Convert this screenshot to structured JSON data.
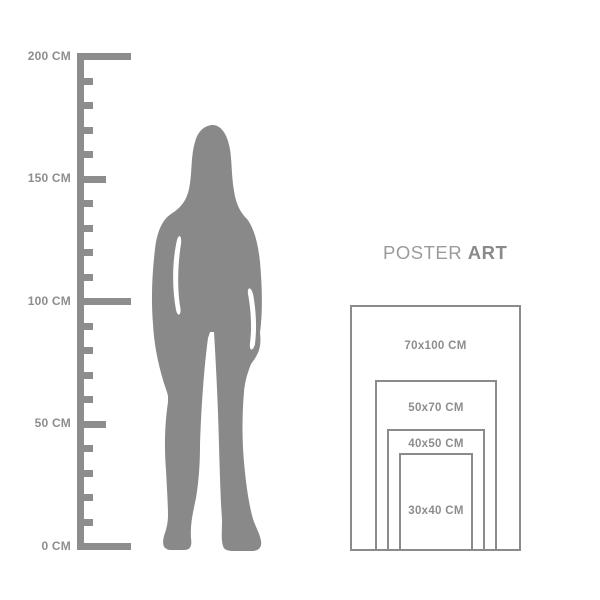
{
  "title": {
    "normal": "POSTER",
    "bold": "ART"
  },
  "ruler": {
    "unit": "CM",
    "labels": [
      "200 CM",
      "150 CM",
      "100 CM",
      "50 CM",
      "0 CM"
    ]
  },
  "posters": {
    "sizes": [
      {
        "label": "70x100 CM"
      },
      {
        "label": "50x70 CM"
      },
      {
        "label": "40x50 CM"
      },
      {
        "label": "30x40 CM"
      }
    ]
  },
  "colors": {
    "gray": "#898989",
    "ruler_gray": "#8d8d8d",
    "rect_border": "#8b8b8b",
    "title_normal": "#9b9b9b",
    "title_bold": "#8a8a8a",
    "background": "#ffffff"
  }
}
